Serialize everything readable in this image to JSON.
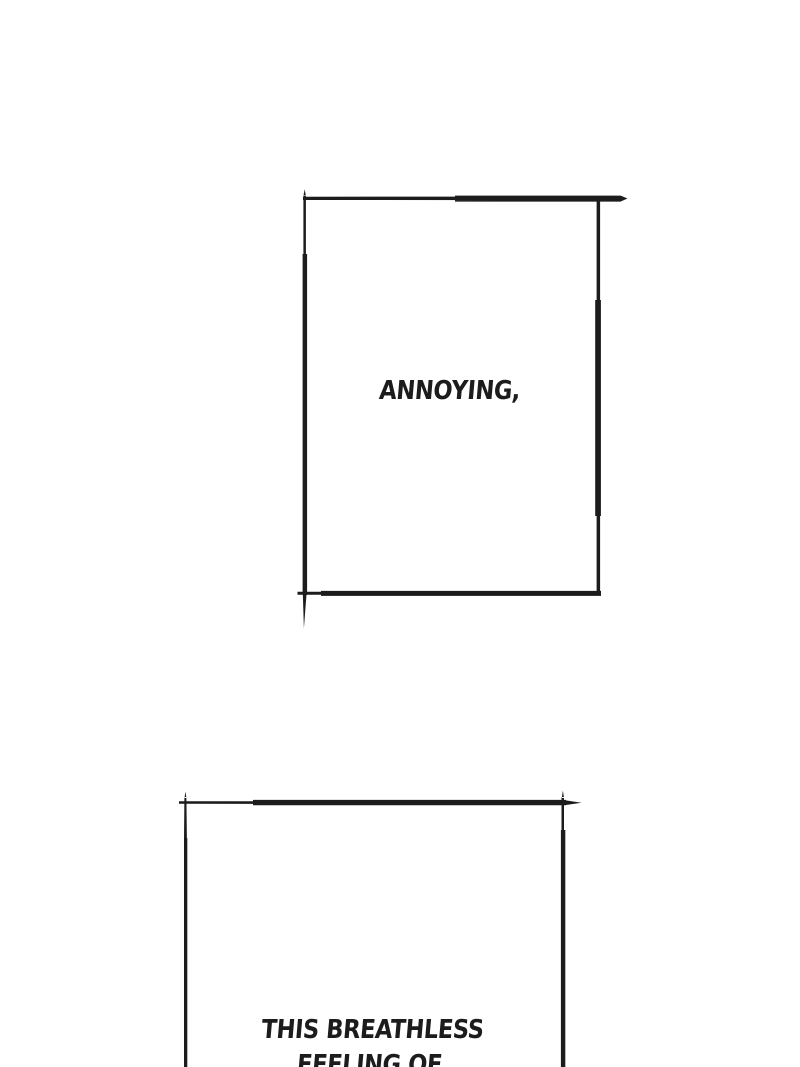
{
  "page": {
    "background_color": "#ffffff",
    "ink_color": "#1c1c1c"
  },
  "panels": [
    {
      "name": "panel-1",
      "dialogue": "ANNOYING,"
    },
    {
      "name": "panel-2",
      "dialogue_line1": "THIS BREATHLESS",
      "dialogue_line2": "FEELING OF"
    }
  ]
}
